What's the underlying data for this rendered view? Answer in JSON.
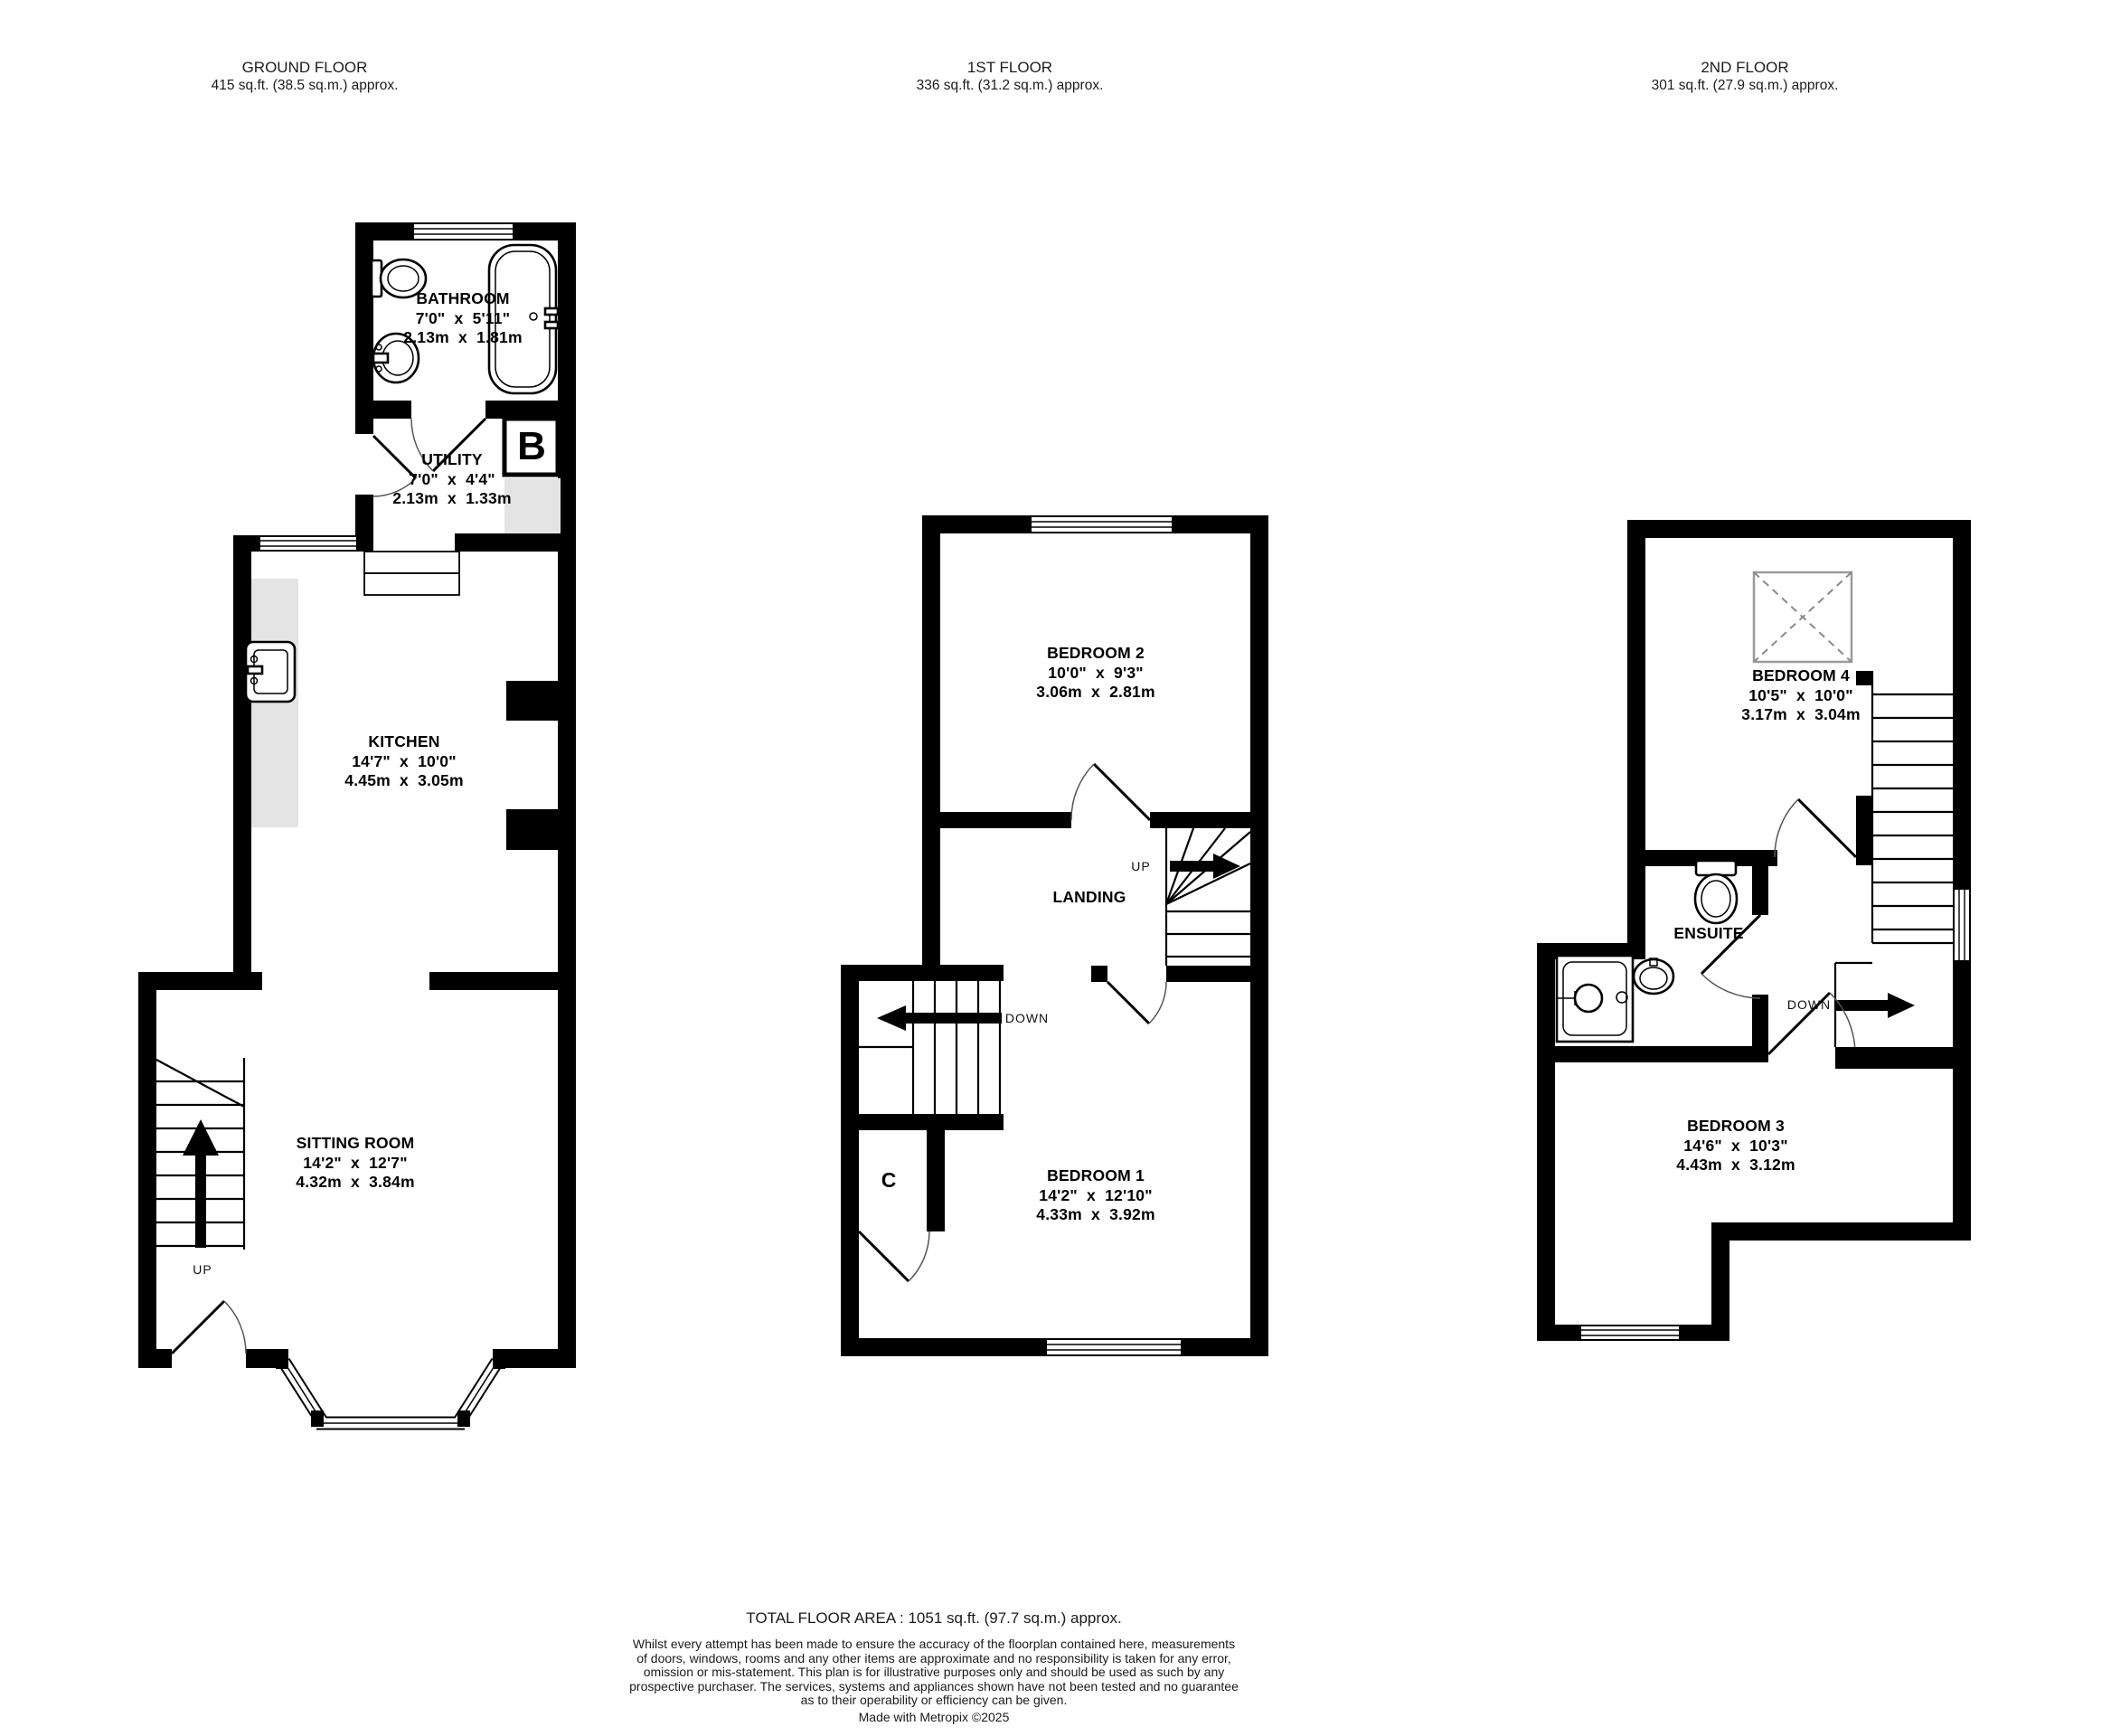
{
  "floors": {
    "ground": {
      "title": "GROUND FLOOR",
      "area": "415 sq.ft. (38.5 sq.m.) approx.",
      "rooms": {
        "bathroom": {
          "name": "BATHROOM",
          "imperial": "7'0\"  x  5'11\"",
          "metric": "2.13m  x  1.81m"
        },
        "utility": {
          "name": "UTILITY",
          "imperial": "7'0\"  x  4'4\"",
          "metric": "2.13m  x  1.33m"
        },
        "kitchen": {
          "name": "KITCHEN",
          "imperial": "14'7\"  x  10'0\"",
          "metric": "4.45m  x  3.05m"
        },
        "sitting_room": {
          "name": "SITTING ROOM",
          "imperial": "14'2\"  x  12'7\"",
          "metric": "4.32m  x  3.84m"
        }
      },
      "annotations": {
        "up": "UP",
        "boiler": "B"
      }
    },
    "first": {
      "title": "1ST FLOOR",
      "area": "336 sq.ft. (31.2 sq.m.) approx.",
      "rooms": {
        "bedroom2": {
          "name": "BEDROOM 2",
          "imperial": "10'0\"  x  9'3\"",
          "metric": "3.06m  x  2.81m"
        },
        "landing": {
          "name": "LANDING"
        },
        "bedroom1": {
          "name": "BEDROOM 1",
          "imperial": "14'2\"  x  12'10\"",
          "metric": "4.33m  x  3.92m"
        }
      },
      "annotations": {
        "up": "UP",
        "down": "DOWN",
        "cupboard": "C"
      }
    },
    "second": {
      "title": "2ND FLOOR",
      "area": "301 sq.ft. (27.9 sq.m.) approx.",
      "rooms": {
        "bedroom4": {
          "name": "BEDROOM 4",
          "imperial": "10'5\"  x  10'0\"",
          "metric": "3.17m  x  3.04m"
        },
        "ensuite": {
          "name": "ENSUITE"
        },
        "bedroom3": {
          "name": "BEDROOM 3",
          "imperial": "14'6\"  x  10'3\"",
          "metric": "4.43m  x  3.12m"
        }
      },
      "annotations": {
        "down": "DOWN"
      }
    }
  },
  "footer": {
    "total": "TOTAL FLOOR AREA : 1051 sq.ft. (97.7 sq.m.) approx.",
    "disclaimer_lines": [
      "Whilst every attempt has been made to ensure the accuracy of the floorplan contained here, measurements",
      "of doors, windows, rooms and any other items are approximate and no responsibility is taken for any error,",
      "omission or mis-statement. This plan is for illustrative purposes only and should be used as such by any",
      "prospective purchaser. The services, systems and appliances shown have not been tested and no guarantee",
      "as to their operability or efficiency can be given."
    ],
    "credit": "Made with Metropix ©2025"
  },
  "colors": {
    "wall": "#000000",
    "counter_gray": "#e4e4e4",
    "window_white": "#ffffff"
  }
}
